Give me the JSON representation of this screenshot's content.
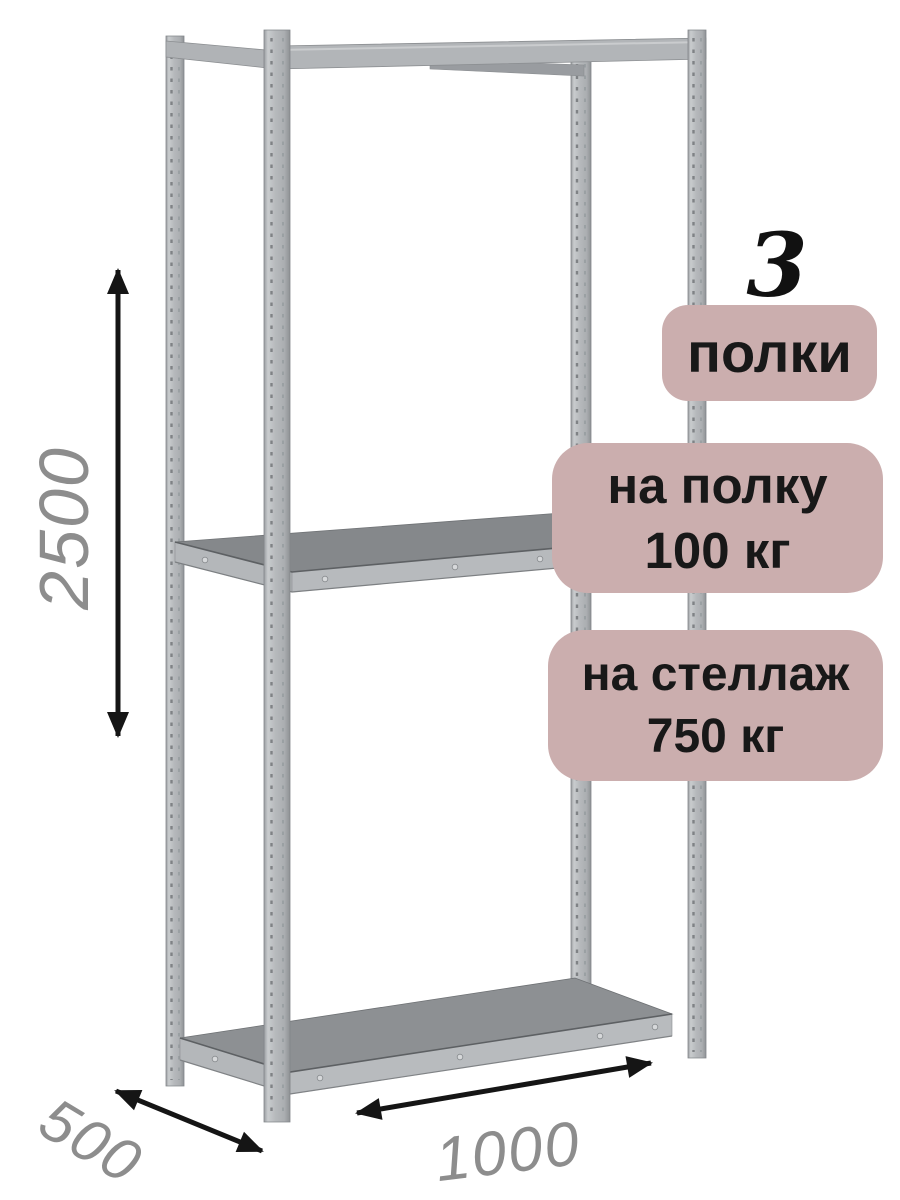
{
  "annotations": {
    "shelf_count": {
      "number": "3",
      "label": "полки"
    },
    "shelf_load": {
      "line1": "на полку",
      "line2": "100 кг"
    },
    "rack_load": {
      "line1": "на стеллаж",
      "line2": "750 кг"
    }
  },
  "dimensions": {
    "height": "2500",
    "depth": "500",
    "width": "1000"
  },
  "icons": {
    "height_arrow": "double-headed-vertical-arrow-icon",
    "depth_arrow": "double-headed-diagonal-arrow-icon",
    "width_arrow": "double-headed-diagonal-arrow-icon"
  },
  "colors": {
    "background": "#ffffff",
    "badge_background": "#cbaeae",
    "badge_text": "#181818",
    "count_number": "#111111",
    "dimension_text": "#8d8d8d",
    "arrow": "#151515",
    "rack_metal_light": "#c9ccce",
    "rack_metal_mid": "#b4b7ba",
    "rack_shelf_surface": "#8b8e91"
  }
}
